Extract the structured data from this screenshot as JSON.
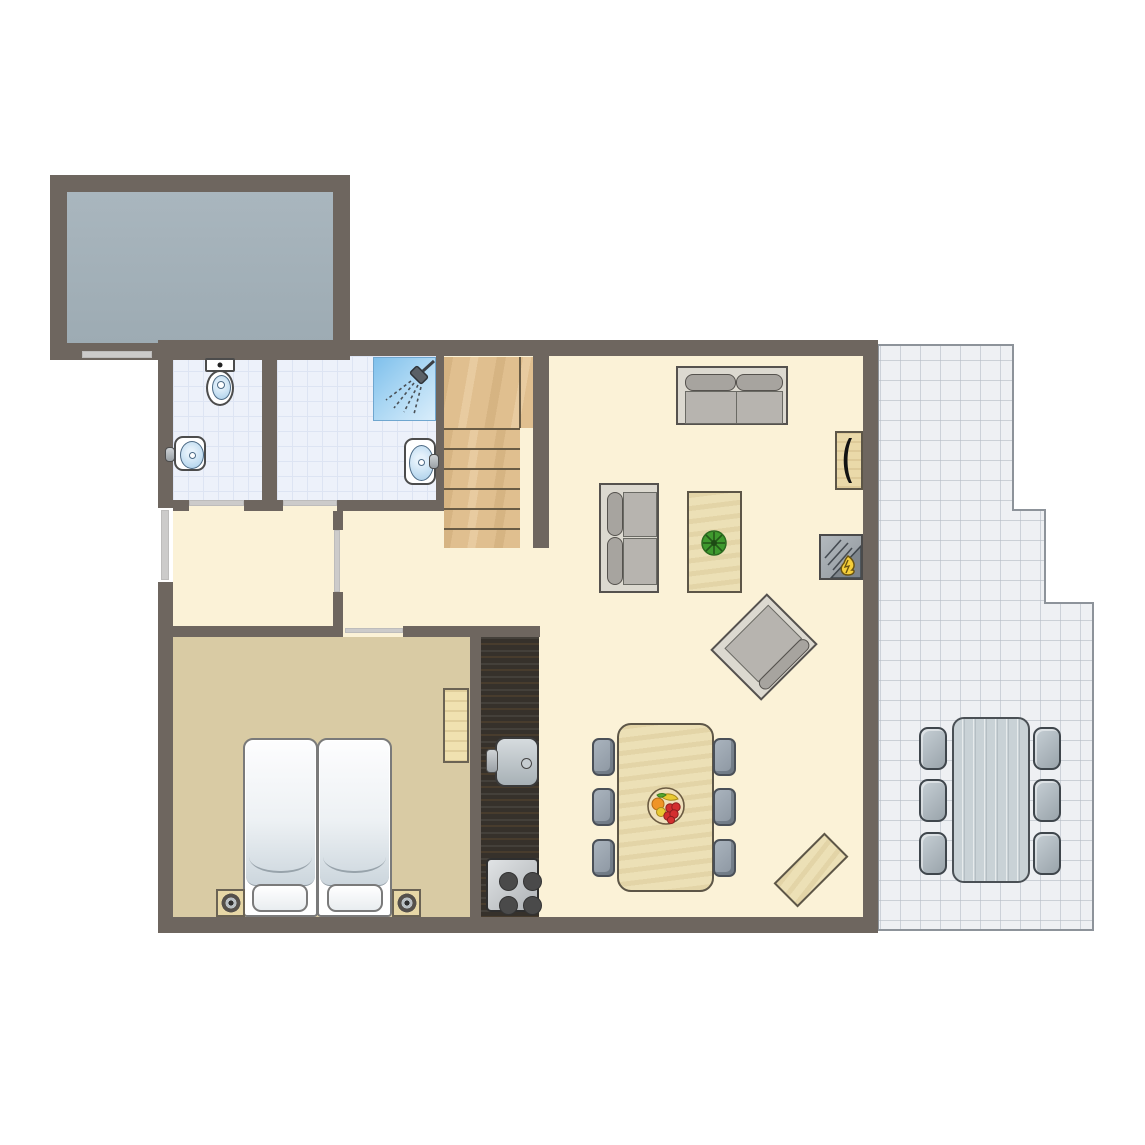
{
  "title": "apartment-floor-plan",
  "canvas": {
    "w": 1145,
    "h": 1145
  },
  "colors": {
    "wall": "#6e665f",
    "floor": "#fbf2d7",
    "bedroomFloor": "#d9cba4",
    "bathTile": "#edf1fa",
    "bathTileLine": "#dde4f3",
    "balcony1": "#a9b6be",
    "balcony2": "#9dabb3",
    "terraceTile": "#eef0f3",
    "terraceLine": "#b6bdc6",
    "terraceEdge": "#8d939a",
    "doorMarker": "#cccbca",
    "stairWood": "#e0bf8f",
    "tableWood": "#ece0b6",
    "counterDark": "#36312b",
    "sofaFrame": "#dcd9d0",
    "sofaSeat": "#b7b4af",
    "sofaBack": "#a7a49f",
    "outdoorTable": "#c9d2d6",
    "shower": "#8ac5ee",
    "basin": "#c5dff2",
    "flame": "#f6cf3a",
    "plant": "#3f992e",
    "outline": "#4a4a4a"
  },
  "rooms": {
    "balcony": {
      "name": "balcony",
      "rect": [
        67,
        192,
        266,
        151
      ]
    },
    "base": {
      "name": "interior",
      "rect": [
        173,
        356,
        690,
        561
      ]
    },
    "wc": {
      "name": "wc",
      "rect": [
        173,
        356,
        89,
        144
      ]
    },
    "bathroom": {
      "name": "bathroom",
      "rect": [
        277,
        356,
        159,
        144
      ]
    },
    "bedroom": {
      "name": "bedroom",
      "rect": [
        173,
        637,
        297,
        280
      ]
    }
  },
  "terrace": {
    "name": "terrace",
    "polygon": [
      [
        878,
        345
      ],
      [
        1013,
        345
      ],
      [
        1013,
        510
      ],
      [
        1045,
        510
      ],
      [
        1045,
        603
      ],
      [
        1093,
        603
      ],
      [
        1093,
        930
      ],
      [
        878,
        930
      ]
    ],
    "tile_size": 20,
    "table": [
      952,
      717,
      78,
      166
    ],
    "chair_w": 28,
    "chair_h": 43,
    "chairs": [
      [
        919,
        727
      ],
      [
        919,
        779
      ],
      [
        919,
        832
      ],
      [
        1033,
        727
      ],
      [
        1033,
        779
      ],
      [
        1033,
        832
      ]
    ]
  },
  "walls": [
    {
      "id": "balcony-top",
      "rect": [
        50,
        175,
        300,
        17
      ]
    },
    {
      "id": "balcony-left",
      "rect": [
        50,
        192,
        17,
        151
      ]
    },
    {
      "id": "balcony-right",
      "rect": [
        333,
        192,
        17,
        151
      ]
    },
    {
      "id": "balcony-bottom",
      "rect": [
        50,
        343,
        300,
        17
      ]
    },
    {
      "id": "main-top",
      "rect": [
        158,
        340,
        720,
        16
      ]
    },
    {
      "id": "main-right",
      "rect": [
        863,
        340,
        15,
        593
      ]
    },
    {
      "id": "main-bottom",
      "rect": [
        158,
        917,
        720,
        16
      ]
    },
    {
      "id": "main-left-upper",
      "rect": [
        158,
        340,
        15,
        168
      ]
    },
    {
      "id": "main-left-lower",
      "rect": [
        158,
        582,
        15,
        351
      ]
    },
    {
      "id": "wc-bath-divider",
      "rect": [
        262,
        340,
        15,
        171
      ]
    },
    {
      "id": "bath-stairs-divider",
      "rect": [
        436,
        340,
        8,
        171
      ]
    },
    {
      "id": "bath-bottom-a",
      "rect": [
        173,
        500,
        16,
        11
      ]
    },
    {
      "id": "bath-bottom-b",
      "rect": [
        244,
        500,
        39,
        11
      ]
    },
    {
      "id": "bath-bottom-c",
      "rect": [
        337,
        500,
        107,
        11
      ]
    },
    {
      "id": "stairs-right",
      "rect": [
        533,
        340,
        16,
        208
      ]
    },
    {
      "id": "hall-divider-a",
      "rect": [
        333,
        511,
        10,
        19
      ]
    },
    {
      "id": "hall-divider-b",
      "rect": [
        333,
        592,
        10,
        34
      ]
    },
    {
      "id": "bedroom-top-a",
      "rect": [
        158,
        626,
        185,
        11
      ]
    },
    {
      "id": "bedroom-top-b",
      "rect": [
        403,
        626,
        137,
        11
      ]
    },
    {
      "id": "kitchen-side",
      "rect": [
        470,
        637,
        11,
        280
      ]
    }
  ],
  "door_markers": [
    {
      "id": "balcony",
      "rect": [
        82,
        351,
        70,
        7
      ]
    },
    {
      "id": "entrance",
      "rect": [
        161,
        510,
        8,
        70
      ]
    },
    {
      "id": "wc",
      "rect": [
        189,
        500,
        55,
        6
      ]
    },
    {
      "id": "bathroom",
      "rect": [
        283,
        500,
        54,
        6
      ]
    },
    {
      "id": "hall",
      "rect": [
        334,
        530,
        6,
        62
      ]
    },
    {
      "id": "bedroom",
      "rect": [
        345,
        628,
        58,
        5
      ]
    }
  ],
  "stairs": {
    "landing": [
      444,
      357,
      89,
      71
    ],
    "landing_divider": [
      519,
      357,
      2,
      71
    ],
    "steps": [
      [
        444,
        428,
        76,
        20
      ],
      [
        444,
        448,
        76,
        20
      ],
      [
        444,
        468,
        76,
        20
      ],
      [
        444,
        488,
        76,
        20
      ],
      [
        444,
        508,
        76,
        20
      ],
      [
        444,
        528,
        76,
        20
      ]
    ]
  },
  "kitchen": {
    "counter": [
      481,
      637,
      58,
      280
    ],
    "sink": [
      495,
      737,
      44,
      50
    ],
    "drain": [
      24,
      19,
      9,
      9
    ],
    "faucet": [
      486,
      749,
      12,
      24
    ],
    "stove": [
      486,
      858,
      53,
      54
    ],
    "burners": [
      [
        11,
        12
      ],
      [
        35,
        12
      ],
      [
        11,
        36
      ],
      [
        35,
        36
      ]
    ]
  },
  "furniture": {
    "sofa_top": {
      "rect": [
        676,
        366,
        112,
        59
      ]
    },
    "sofa_left": {
      "rect": [
        599,
        483,
        60,
        110
      ]
    },
    "coffee_table": {
      "rect": [
        687,
        491,
        55,
        102
      ]
    },
    "plant": {
      "rect": [
        701,
        530,
        26,
        26
      ]
    },
    "sideboard": {
      "rect": [
        835,
        431,
        28,
        59
      ]
    },
    "fireplace": {
      "rect": [
        819,
        534,
        44,
        46
      ]
    },
    "armchair": {
      "rect": [
        724,
        611,
        80,
        72
      ]
    },
    "bench": {
      "rect": [
        775,
        853,
        72,
        34
      ]
    },
    "dining_table": {
      "rect": [
        617,
        723,
        97,
        169
      ]
    },
    "fruit_bowl": {
      "rect": [
        647,
        787,
        38,
        38
      ]
    },
    "dining_chair_w": 23,
    "dining_chair_h": 38,
    "dining_chairs": [
      [
        592,
        738
      ],
      [
        592,
        788
      ],
      [
        592,
        839
      ],
      [
        713,
        738
      ],
      [
        713,
        788
      ],
      [
        713,
        839
      ]
    ],
    "shelf": {
      "rect": [
        443,
        688,
        26,
        75
      ]
    }
  },
  "bedroom_set": {
    "mattress_left": [
      243,
      738,
      75,
      179
    ],
    "mattress_right": [
      317,
      738,
      75,
      179
    ],
    "pillow_left": [
      252,
      884,
      56,
      28
    ],
    "pillow_right": [
      327,
      884,
      56,
      28
    ],
    "nightstand_left": [
      216,
      889,
      29,
      28
    ],
    "nightstand_right": [
      392,
      889,
      29,
      28
    ]
  },
  "bath_fixtures": {
    "toilet_tank": [
      205,
      358,
      30,
      14
    ],
    "toilet_bowl": [
      206,
      370,
      28,
      36
    ],
    "wc_sink": [
      174,
      436,
      32,
      35
    ],
    "wc_faucet": [
      165,
      447,
      10,
      15
    ],
    "bath_sink": [
      404,
      438,
      32,
      47
    ],
    "bath_faucet": [
      429,
      454,
      10,
      15
    ],
    "shower": [
      373,
      357,
      63,
      64
    ]
  }
}
